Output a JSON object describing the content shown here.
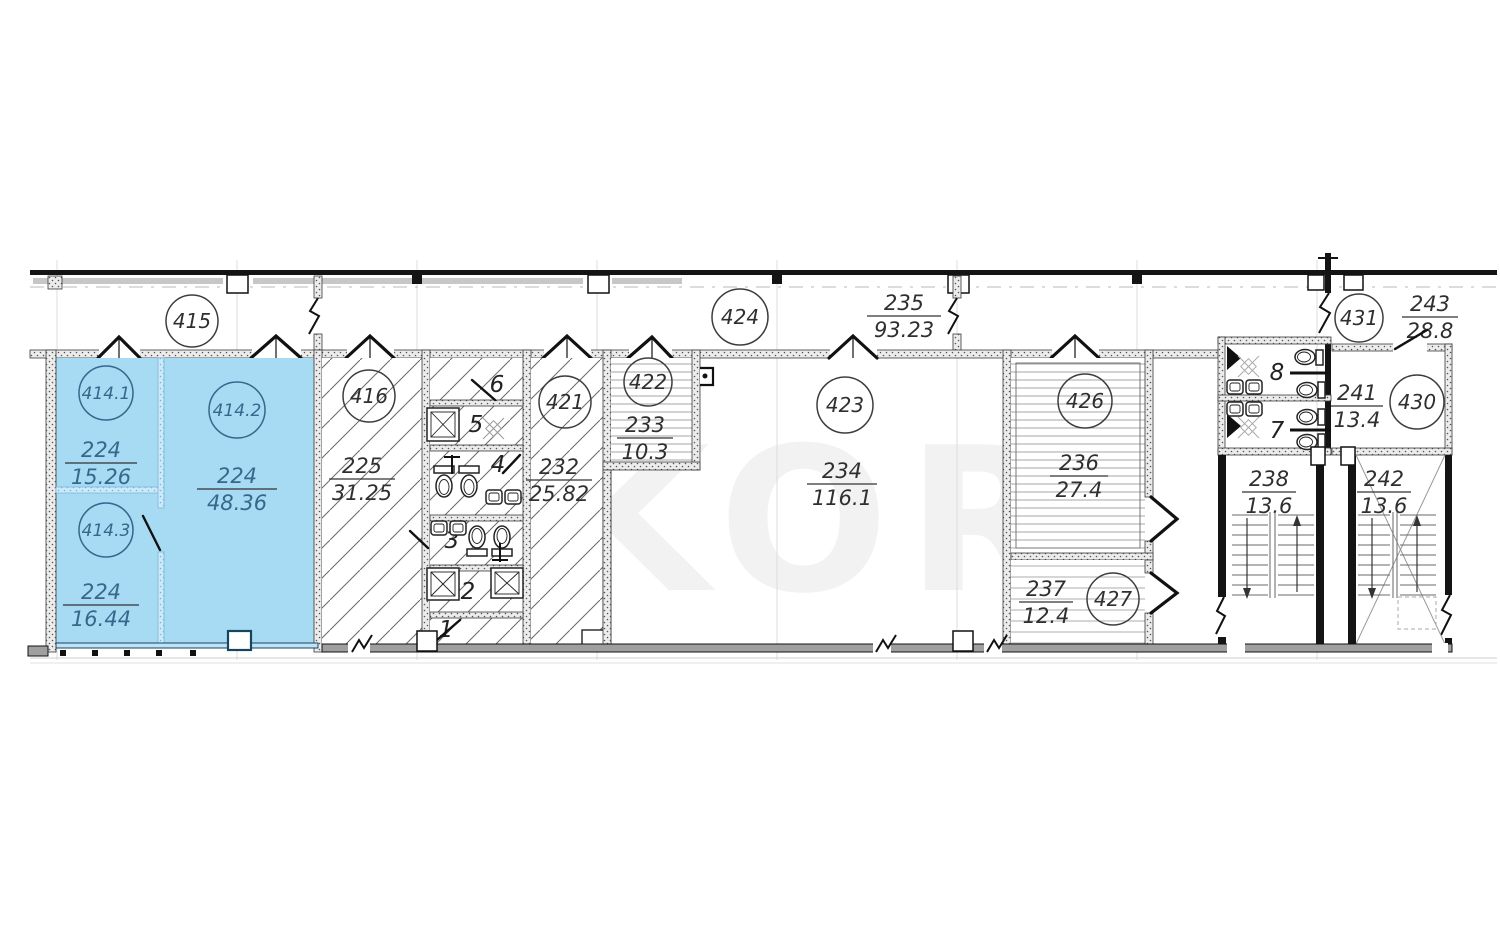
{
  "plan": {
    "watermark": "EKOR",
    "highlight_color": "#a7daf3",
    "rooms": {
      "r414_1": {
        "tag": "414.1",
        "code": "224",
        "area": "15.26"
      },
      "r414_2": {
        "tag": "414.2",
        "code": "224",
        "area": "48.36"
      },
      "r414_3": {
        "tag": "414.3",
        "code": "224",
        "area": "16.44"
      },
      "r415": {
        "tag": "415"
      },
      "r416": {
        "tag": "416",
        "code": "225",
        "area": "31.25"
      },
      "r421": {
        "tag": "421",
        "code": "232",
        "area": "25.82"
      },
      "r422": {
        "tag": "422",
        "code": "233",
        "area": "10.3"
      },
      "r423": {
        "tag": "423",
        "code": "234",
        "area": "116.1"
      },
      "r424": {
        "tag": "424",
        "code": "235",
        "area": "93.23"
      },
      "r426": {
        "tag": "426",
        "code": "236",
        "area": "27.4"
      },
      "r427": {
        "tag": "427",
        "code": "237",
        "area": "12.4"
      },
      "r430": {
        "tag": "430",
        "code": "241",
        "area": "13.4"
      },
      "r431": {
        "tag": "431",
        "code": "243",
        "area": "28.8"
      }
    },
    "stairwells": {
      "s238": {
        "code": "238",
        "area": "13.6"
      },
      "s242": {
        "code": "242",
        "area": "13.6"
      }
    },
    "wc_cells": {
      "c1": "1",
      "c2": "2",
      "c3": "3",
      "c4": "4",
      "c5": "5",
      "c6": "6",
      "c7": "7",
      "c8": "8"
    }
  }
}
